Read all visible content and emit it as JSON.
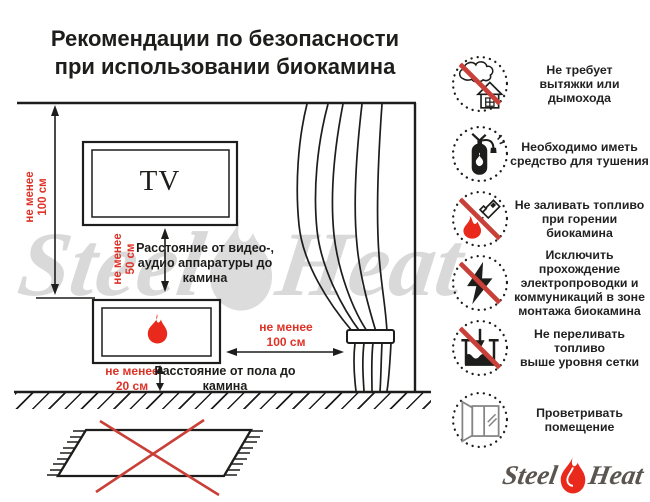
{
  "title": {
    "line1": "Рекомендации по безопасности",
    "line2": "при использовании биокамина"
  },
  "watermark": {
    "left": "Steel",
    "right": "Heat"
  },
  "diagram": {
    "tv_label": "TV",
    "dims": {
      "ceiling_to_fireplace": {
        "lines": [
          "не менее",
          "100 см"
        ]
      },
      "tv_to_fireplace": {
        "lines": [
          "не менее",
          "50 см"
        ]
      },
      "fireplace_to_curtain": {
        "lines": [
          "не менее",
          "100 см"
        ]
      },
      "floor_to_fireplace": {
        "lines": [
          "не менее",
          "20 см"
        ]
      }
    },
    "notes": {
      "av_distance": {
        "lines": [
          "Расстояние от видео-,",
          "аудио аппаратуры до",
          "камина"
        ]
      },
      "floor_distance": {
        "lines": [
          "Расстояние от пола до",
          "камина"
        ]
      }
    }
  },
  "rules": [
    {
      "icon": "no-chimney-icon",
      "lines": [
        "Не требует",
        "вытяжки или дымохода"
      ]
    },
    {
      "icon": "extinguisher-icon",
      "lines": [
        "Необходимо иметь",
        "средство для тушения"
      ]
    },
    {
      "icon": "no-refill-while-burning-icon",
      "lines": [
        "Не заливать топливо",
        "при горении биокамина"
      ]
    },
    {
      "icon": "no-wiring-icon",
      "lines": [
        "Исключить прохождение",
        "электропроводки и",
        "коммуникаций в зоне",
        "монтажа биокамина"
      ]
    },
    {
      "icon": "no-overfill-icon",
      "lines": [
        "Не переливать топливо",
        "выше уровня сетки"
      ]
    },
    {
      "icon": "ventilate-icon",
      "lines": [
        "Проветривать",
        "помещение"
      ]
    }
  ],
  "logo": {
    "steel": "Steel",
    "heat": "Heat"
  },
  "colors": {
    "red_text": "#de3227",
    "red_cross": "#c84038",
    "flame_red": "#e8291c",
    "line_black": "#1d1d1b",
    "watermark_gray": "#d9d9d9",
    "logo_gray": "#5b5550"
  }
}
